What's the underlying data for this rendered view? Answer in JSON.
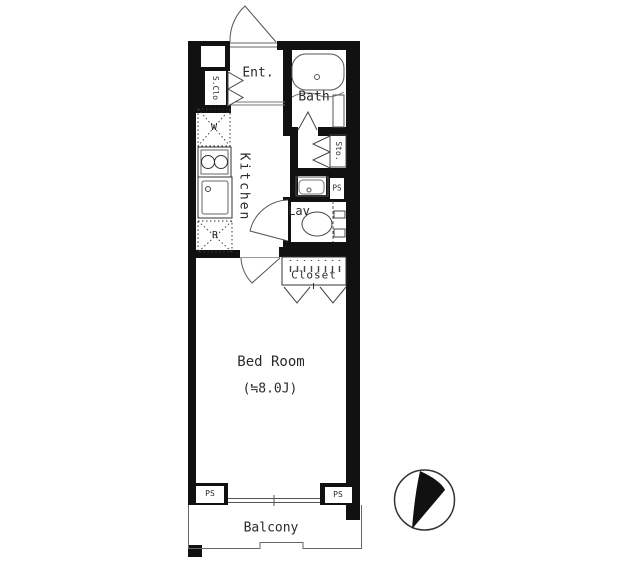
{
  "title": "apartment-floor-plan",
  "colors": {
    "wall": "#111111",
    "fixture_line": "#555555",
    "text": "#2a2a2a",
    "background": "#ffffff"
  },
  "rooms": {
    "entrance": "Ent.",
    "bath": "Bath",
    "kitchen": "Kitchen",
    "shoe_closet": "S.Clo",
    "storage": "Sto.",
    "lavatory": "Lav",
    "closet": "Closet",
    "bedroom_name": "Bed Room",
    "bedroom_size": "(≒8.0J)",
    "balcony": "Balcony"
  },
  "fixtures": {
    "washer": "W",
    "fridge": "R"
  },
  "pipe_space": {
    "middle": "PS",
    "bottom_left": "PS",
    "bottom_right": "PS"
  }
}
